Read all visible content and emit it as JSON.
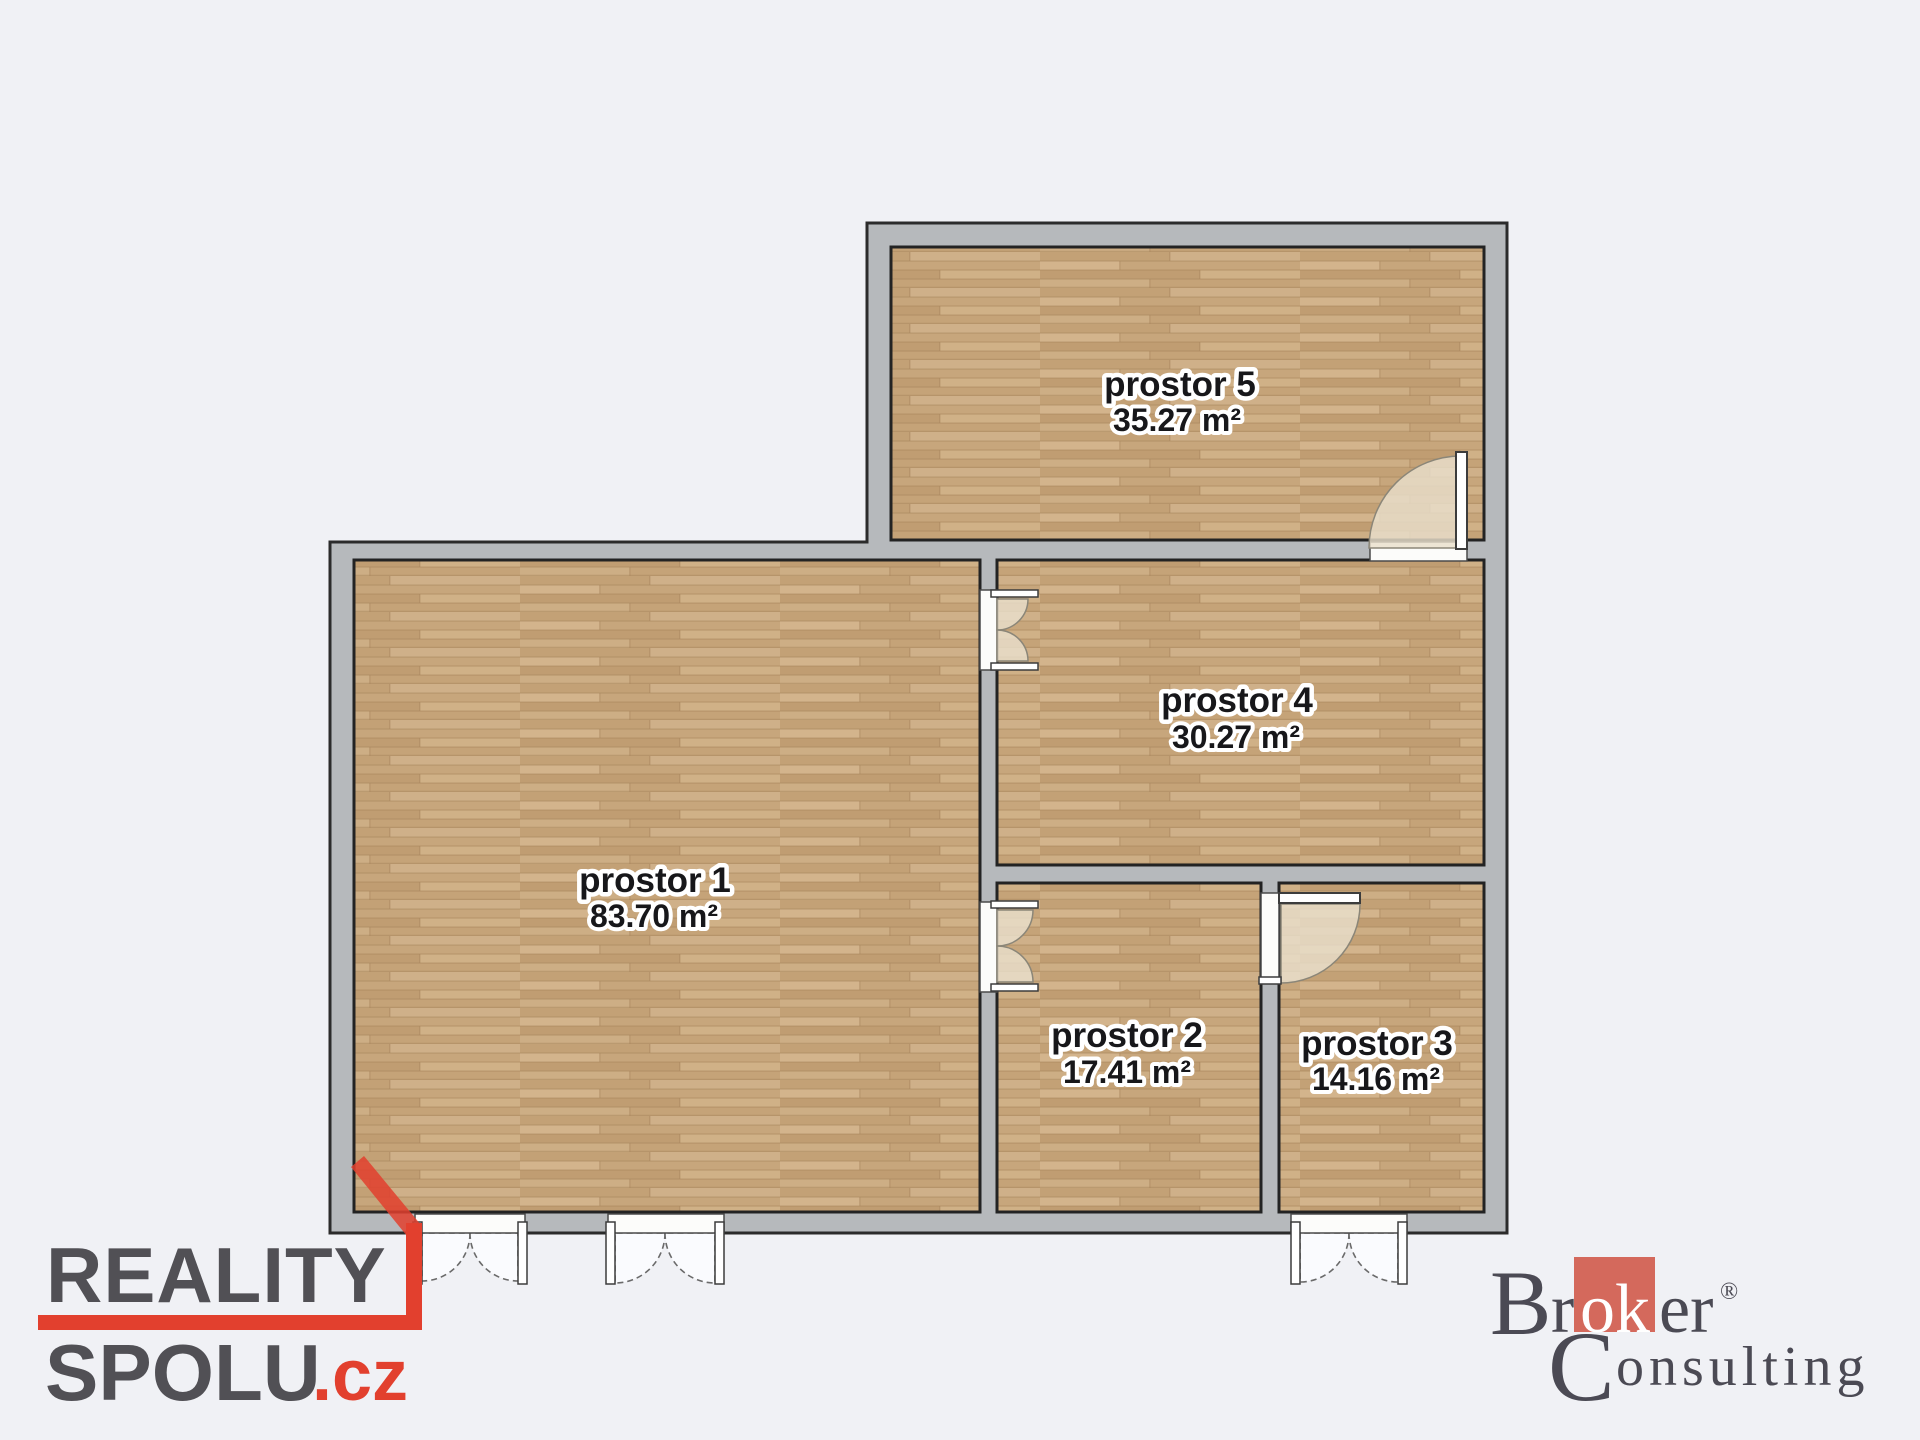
{
  "colors": {
    "background": "#f0f1f5",
    "wall": "#b6b9bc",
    "wall_outline": "#2b2b2b",
    "floor_wood": "#cbab81",
    "floor_seam": "#a8855c",
    "label_text": "#17171a",
    "label_halo": "#ffffff",
    "ribbon_red": "#e2402e",
    "logo_gray": "#515055",
    "broker_text": "#4b4a54",
    "broker_box": "#d4695c",
    "door_swing_beige": "#e9dfcc"
  },
  "plan": {
    "rooms": [
      {
        "name": "prostor 1",
        "area": "83.70 m²"
      },
      {
        "name": "prostor 2",
        "area": "17.41 m²"
      },
      {
        "name": "prostor 3",
        "area": "14.16 m²"
      },
      {
        "name": "prostor 4",
        "area": "30.27 m²"
      },
      {
        "name": "prostor 5",
        "area": "35.27 m²"
      }
    ]
  },
  "logos": {
    "reality_spolu": {
      "word1": "REALITY",
      "word2": "SPOLU",
      "tld": ".cz"
    },
    "broker_consulting": {
      "b": "B",
      "r": "r",
      "ok": "ok",
      "er": "er",
      "registered": "®",
      "c": "C",
      "onsulting": "onsulting"
    }
  }
}
